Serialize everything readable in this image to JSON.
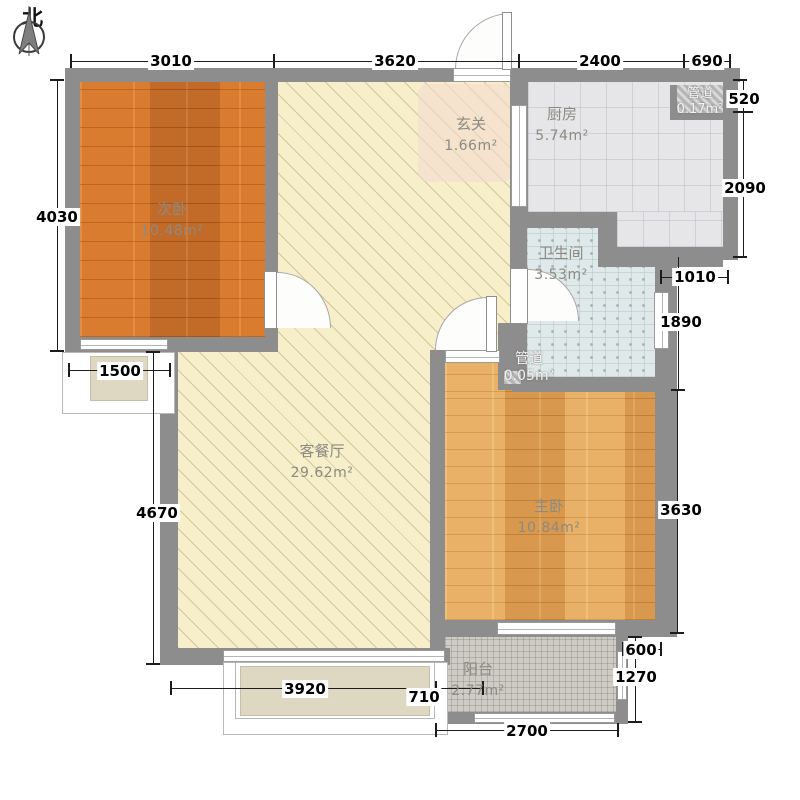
{
  "compass": {
    "north_label": "北"
  },
  "rooms": {
    "second_bedroom": {
      "name": "次卧",
      "area": "10.48m²"
    },
    "hallway": {
      "name": "玄关",
      "area": "1.66m²"
    },
    "kitchen": {
      "name": "厨房",
      "area": "5.74m²"
    },
    "duct_top": {
      "name": "管道",
      "area": "0.17m²"
    },
    "bathroom": {
      "name": "卫生间",
      "area": "3.53m²"
    },
    "duct_small": {
      "name": "管道",
      "area": "0.05m²"
    },
    "living_dining": {
      "name": "客餐厅",
      "area": "29.62m²"
    },
    "master_bedroom": {
      "name": "主卧",
      "area": "10.84m²"
    },
    "balcony": {
      "name": "阳台",
      "area": "2.77m²"
    }
  },
  "dims": {
    "top": [
      "3010",
      "3620",
      "2400",
      "690"
    ],
    "left": [
      "4030",
      "1500",
      "4670"
    ],
    "right": [
      "520",
      "2090",
      "1010",
      "1890",
      "3630",
      "600",
      "1270"
    ],
    "bottom": [
      "3920",
      "710",
      "2700"
    ]
  },
  "colors": {
    "wall": "#8d8d8d",
    "second_bedroom_wood": "#d0752f",
    "master_bedroom_wood": "#e2a357",
    "living_floor": "#f7efca",
    "kitchen_tile": "#e6e6e8",
    "bathroom_tile": "#e0e9e9",
    "balcony_tile": "#cfccc5"
  }
}
